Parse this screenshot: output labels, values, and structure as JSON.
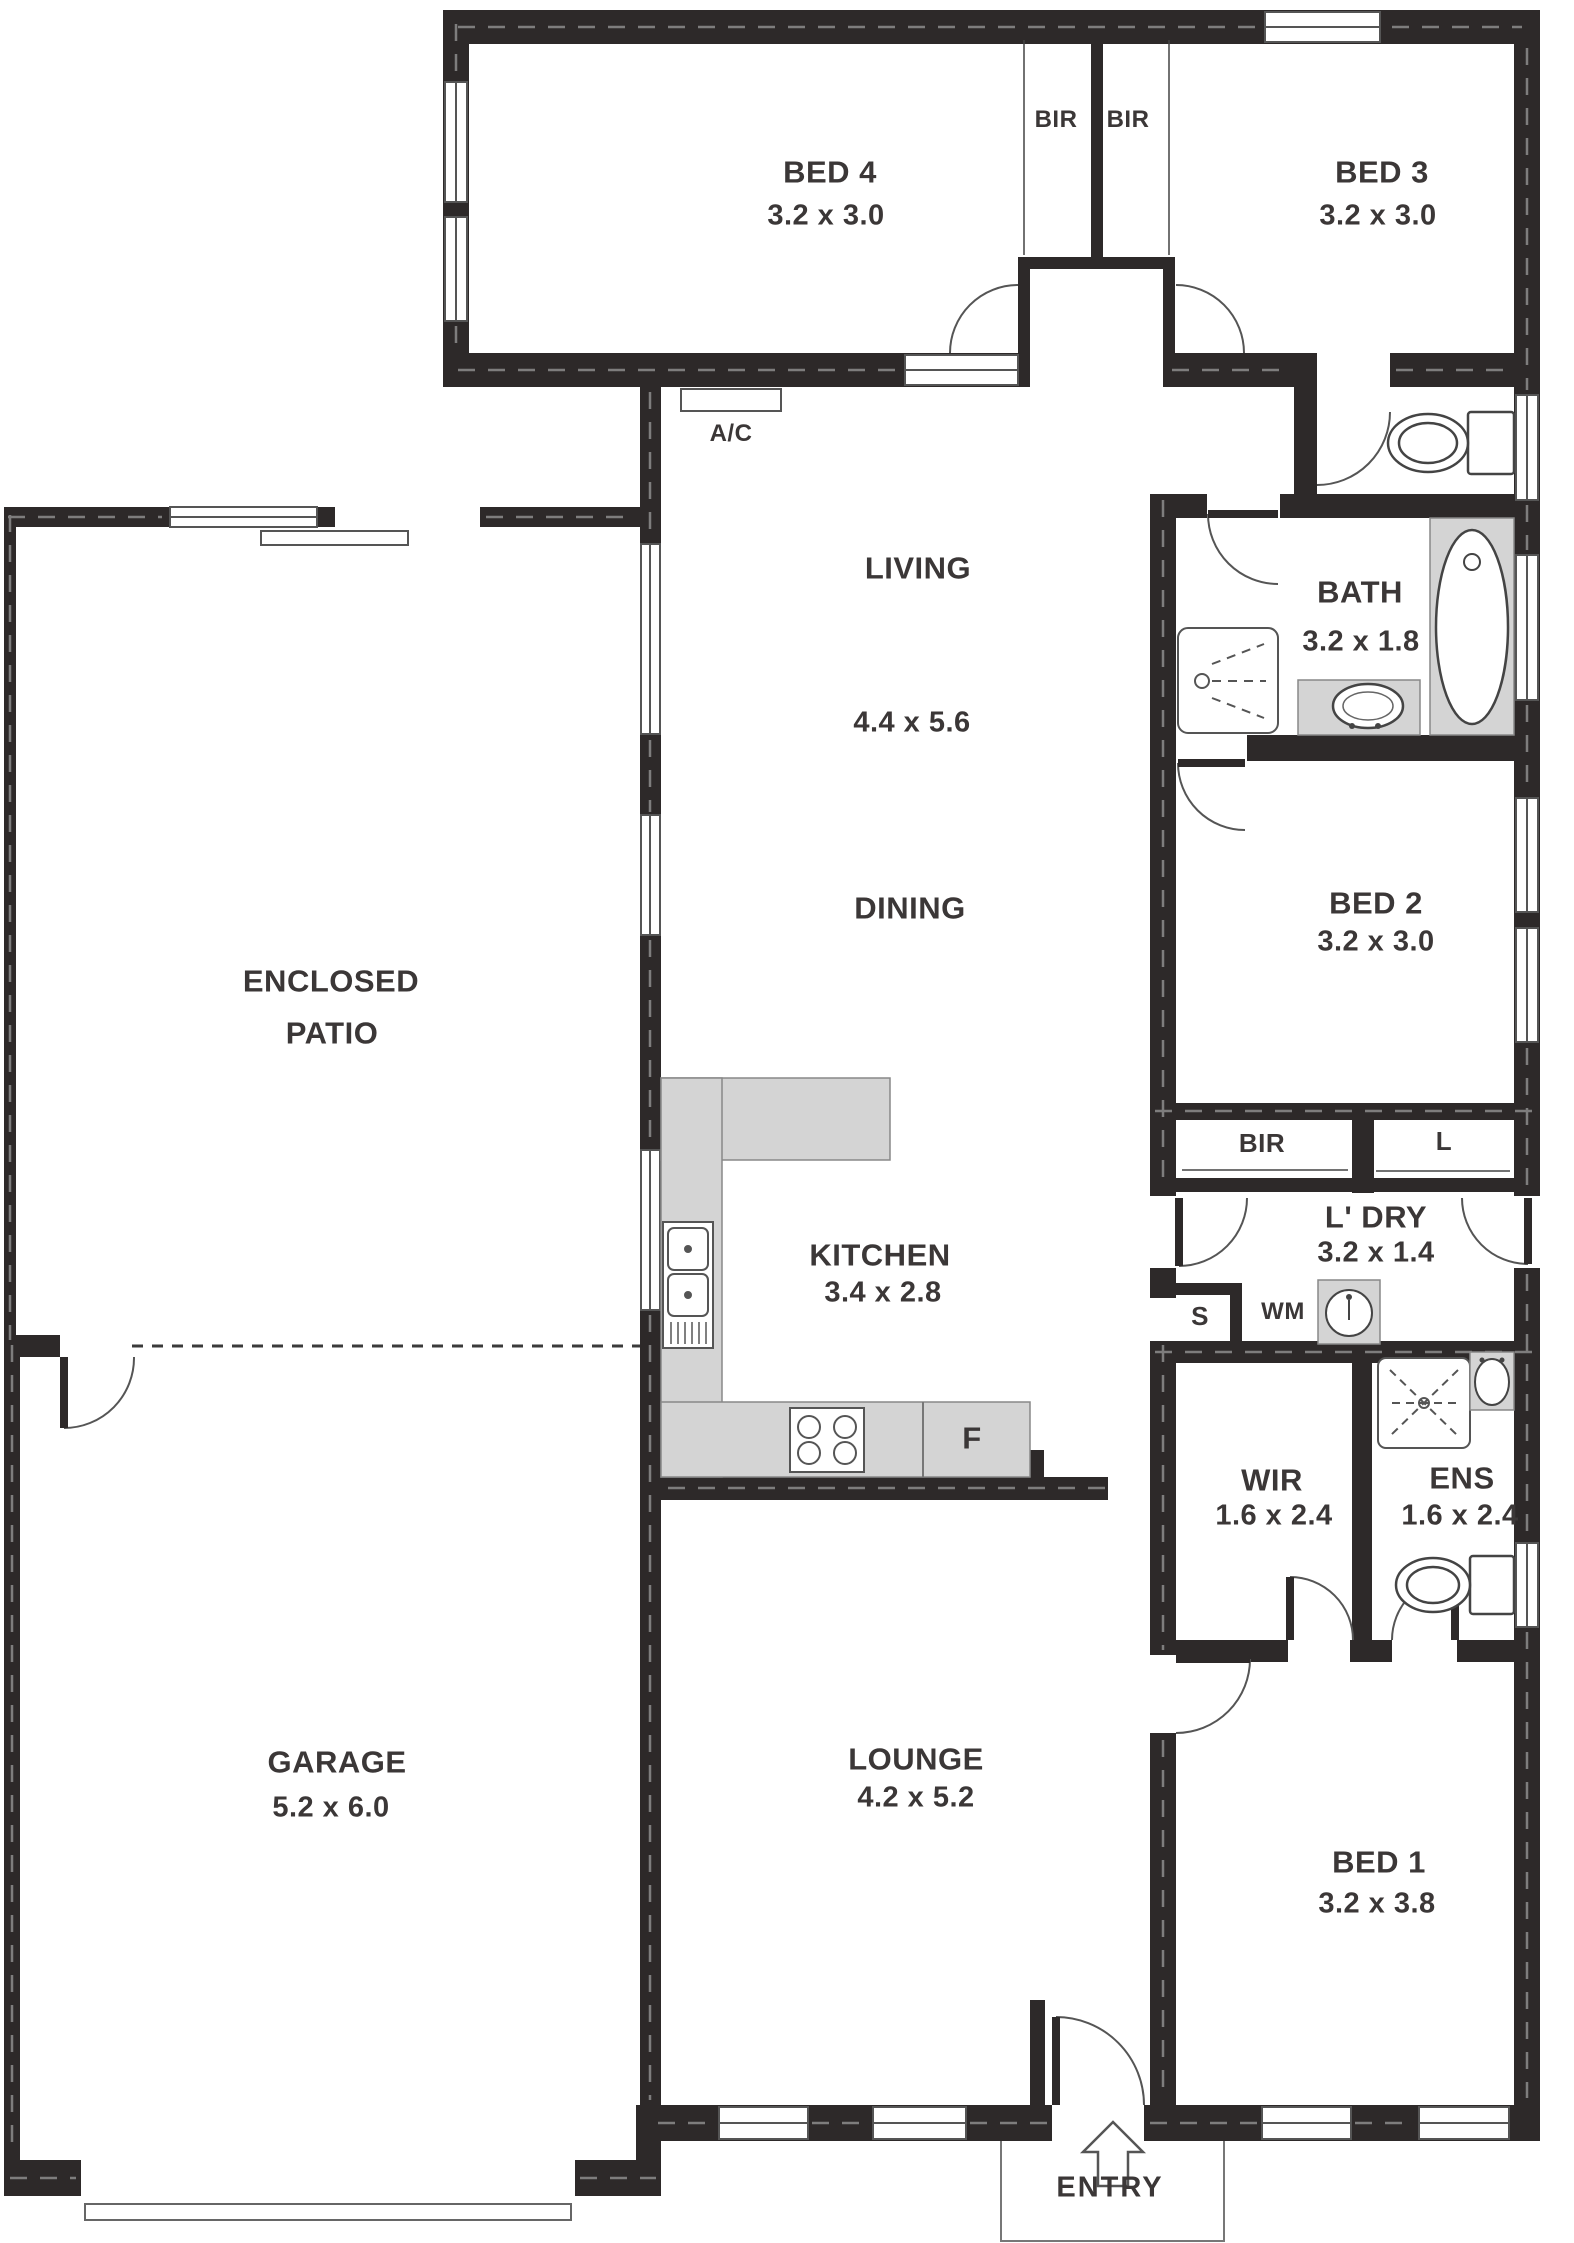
{
  "rooms": {
    "bed4": {
      "name": "BED 4",
      "dims": "3.2 x 3.0"
    },
    "bed3": {
      "name": "BED 3",
      "dims": "3.2 x 3.0"
    },
    "living": {
      "name": "LIVING",
      "dims": "4.4 x 5.6"
    },
    "dining": {
      "name": "DINING"
    },
    "patio": {
      "line1": "ENCLOSED",
      "line2": "PATIO"
    },
    "bath": {
      "name": "BATH",
      "dims": "3.2 x 1.8"
    },
    "bed2": {
      "name": "BED 2",
      "dims": "3.2 x 3.0"
    },
    "kitchen": {
      "name": "KITCHEN",
      "dims": "3.4 x 2.8"
    },
    "laundry": {
      "name": "L' DRY",
      "dims": "3.2 x 1.4"
    },
    "wir": {
      "name": "WIR",
      "dims": "1.6 x 2.4"
    },
    "ens": {
      "name": "ENS",
      "dims": "1.6 x 2.4"
    },
    "garage": {
      "name": "GARAGE",
      "dims": "5.2 x 6.0"
    },
    "lounge": {
      "name": "LOUNGE",
      "dims": "4.2 x 5.2"
    },
    "bed1": {
      "name": "BED 1",
      "dims": "3.2 x 3.8"
    }
  },
  "closets": {
    "bir_left": "BIR",
    "bir_right": "BIR",
    "bir_bed2": "BIR",
    "linen": "L",
    "store": "S"
  },
  "appliances": {
    "ac": "A/C",
    "washing_machine": "WM",
    "fridge": "F"
  },
  "entry": {
    "label": "ENTRY"
  },
  "colors": {
    "wall": "#2d2929",
    "counter": "#d4d4d4",
    "text": "#3b3737"
  }
}
